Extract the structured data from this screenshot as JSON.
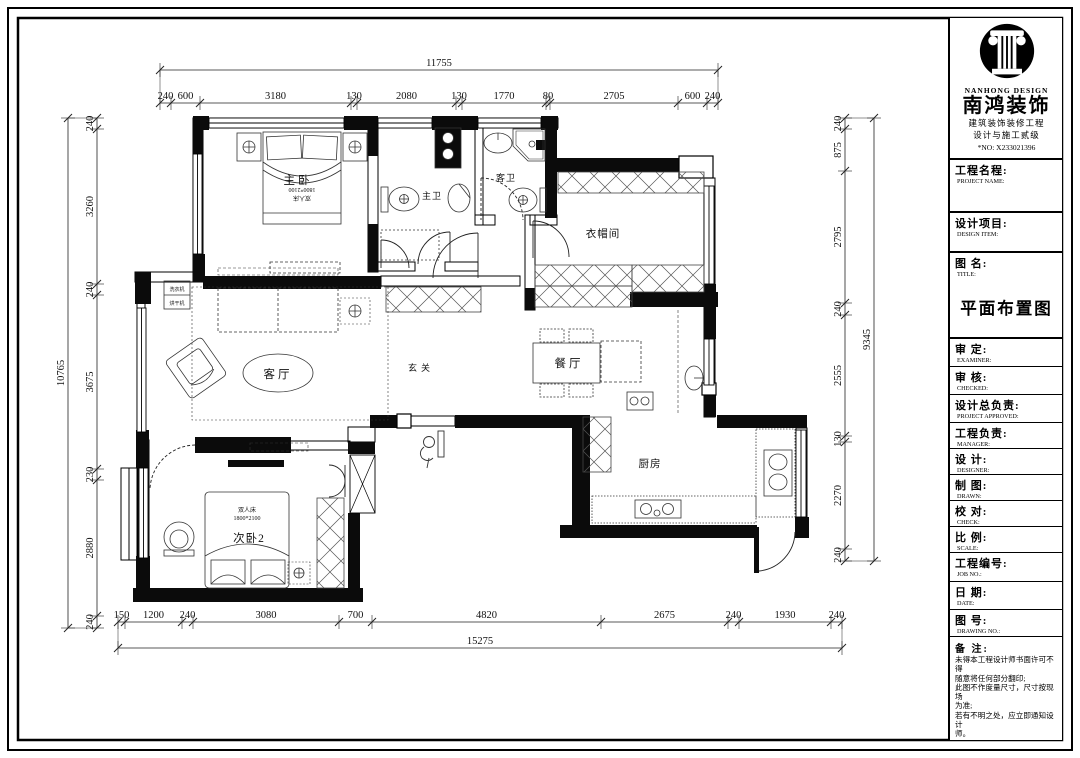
{
  "plan": {
    "rooms": {
      "master": "主卧",
      "master_bath": "主卫",
      "guest_bath": "客卫",
      "cloak": "衣帽间",
      "living": "客厅",
      "foyer": "玄关",
      "dining": "餐厅",
      "kitchen": "厨房",
      "bedroom2": "次卧2"
    },
    "labels": {
      "bed_type": "双人床",
      "bed_size": "1800*2100",
      "washer": "洗衣机",
      "dryer": "烘干机"
    },
    "dimensions": {
      "top": {
        "total": "11755",
        "segments": [
          "240",
          "600",
          "3180",
          "130",
          "2080",
          "130",
          "1770",
          "80",
          "2705",
          "600",
          "240"
        ]
      },
      "bottom": {
        "total": "15275",
        "segments": [
          "150",
          "1200",
          "240",
          "3080",
          "700",
          "4820",
          "2675",
          "240",
          "1930",
          "240"
        ]
      },
      "left": {
        "total": "10765",
        "segments": [
          "240",
          "3260",
          "240",
          "3675",
          "230",
          "2880",
          "240"
        ]
      },
      "right": {
        "total": "9345",
        "segments": [
          "240",
          "875",
          "2795",
          "240",
          "2555",
          "130",
          "2270",
          "240"
        ]
      }
    }
  },
  "title_block": {
    "logo": {
      "brand_en": "NANHONG DESIGN",
      "brand_cn": "南鸿装饰",
      "cert_line1": "建筑装饰装修工程",
      "cert_line2": "设计与施工贰级",
      "cert_no": "*NO: X233021396"
    },
    "project_name": {
      "cn": "工程名程:",
      "en": "PROJECT NAME:"
    },
    "design_item": {
      "cn": "设计项目:",
      "en": "DESIGN ITEM:"
    },
    "drawing_title": {
      "cn": "图  名:",
      "en": "TITLE:",
      "value": "平面布置图"
    },
    "fields": [
      {
        "cn": "审    定:",
        "en": "EXAMINER:"
      },
      {
        "cn": "审    核:",
        "en": "CHECKED:"
      },
      {
        "cn": "设计总负责:",
        "en": "PROJECT APPROVED:"
      },
      {
        "cn": "工程负责:",
        "en": "MANAGER:"
      },
      {
        "cn": "设    计:",
        "en": "DESIGNER:"
      },
      {
        "cn": "制    图:",
        "en": "DRAWN:"
      },
      {
        "cn": "校    对:",
        "en": "CHECK:"
      },
      {
        "cn": "比    例:",
        "en": "SCALE:"
      },
      {
        "cn": "工程编号:",
        "en": "JOB NO.:"
      },
      {
        "cn": "日    期:",
        "en": "DATE:"
      },
      {
        "cn": "图    号:",
        "en": "DRAWING NO.:"
      }
    ],
    "notes": {
      "label": "备  注:",
      "lines": [
        "未得本工程设计师书面许可不得",
        "随意将任何部分翻印;",
        "此图不作度量尺寸，尺寸按现场",
        "为准;",
        "若有不明之处，应立即通知设计",
        "师。"
      ],
      "disclaimer": "本设计解释权归设计师所有。",
      "hotline": "免费咨询电话:400 8383 168"
    }
  }
}
